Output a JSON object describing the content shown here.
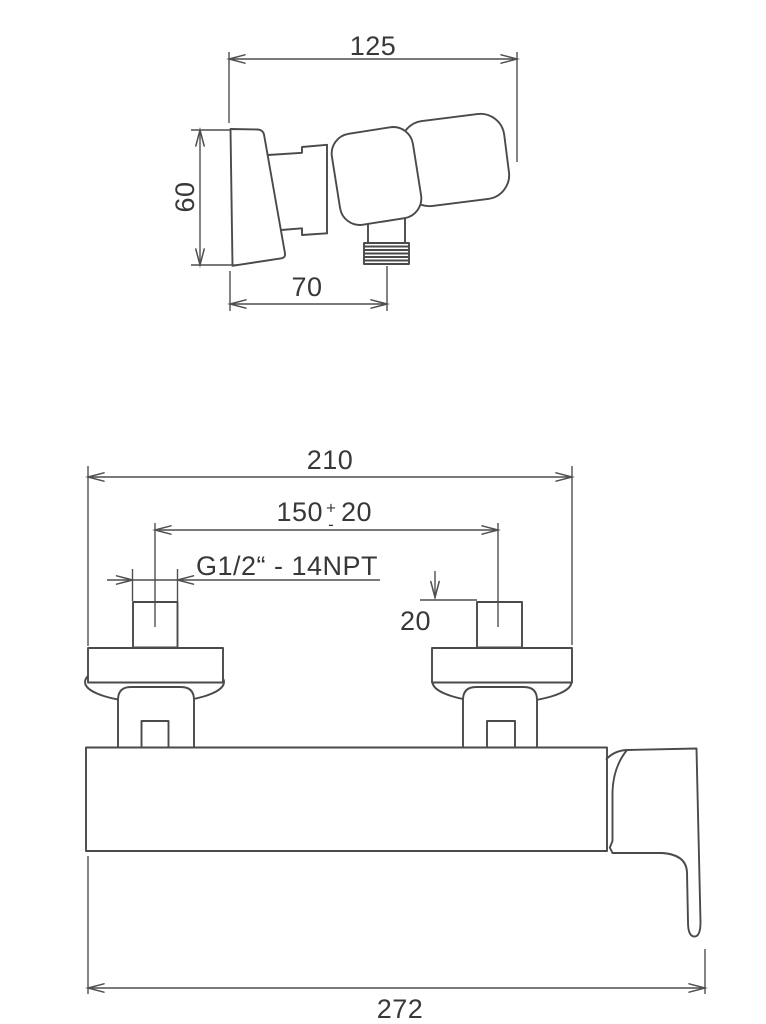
{
  "drawing": {
    "background": "#ffffff",
    "line_color": "#4a4a4a",
    "text_color": "#383838",
    "side_view": {
      "dims": {
        "depth": {
          "value": "125"
        },
        "height": {
          "value": "60"
        },
        "outlet_offset": {
          "value": "70"
        }
      }
    },
    "front_view": {
      "dims": {
        "flange_span": {
          "value": "210"
        },
        "center_distance": {
          "value": "150",
          "plus": "+",
          "minus": "-",
          "tolerance": "20"
        },
        "thread": {
          "label": "G1/2“ - 14NPT"
        },
        "nipple_length": {
          "value": "20"
        },
        "overall_width": {
          "value": "272"
        }
      }
    }
  }
}
